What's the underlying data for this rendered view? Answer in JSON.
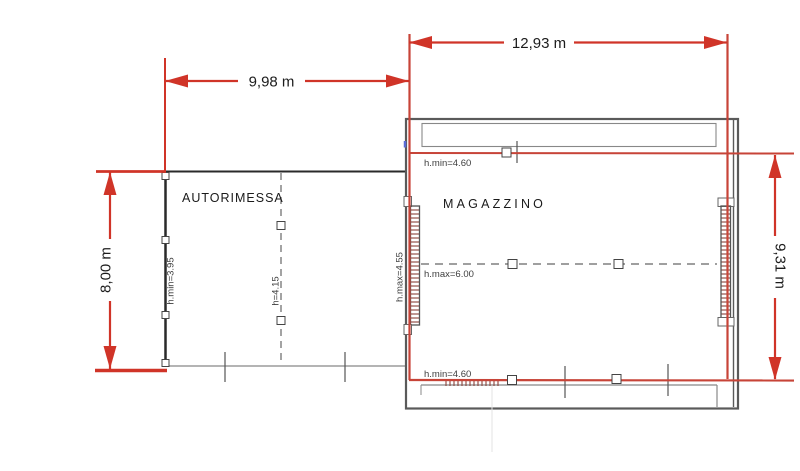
{
  "drawing": {
    "rooms": {
      "autorimessa": {
        "name": "AUTORIMESSA",
        "h_min_left": "h.min=3.95",
        "h_center": "h=4.15"
      },
      "magazzino": {
        "name": "MAGAZZINO",
        "h_min_top": "h.min=4.60",
        "h_max_left": "h.max=4.55",
        "h_max_center": "h.max=6.00",
        "h_min_bottom": "h.min=4.60"
      }
    },
    "dimensions": {
      "autorimessa_width": "9,98 m",
      "magazzino_width": "12,93 m",
      "autorimessa_height": "8,00 m",
      "magazzino_height": "9,31 m"
    },
    "colors": {
      "dimension_red": "#d03428",
      "outline_red": "#c74438",
      "wall_black": "#2a2a2a",
      "wall_gray": "#5a5a5a",
      "hatch_brown": "#8a4038",
      "label_gray": "#3e3e3e",
      "snap_blue": "#5b6bd5"
    }
  }
}
